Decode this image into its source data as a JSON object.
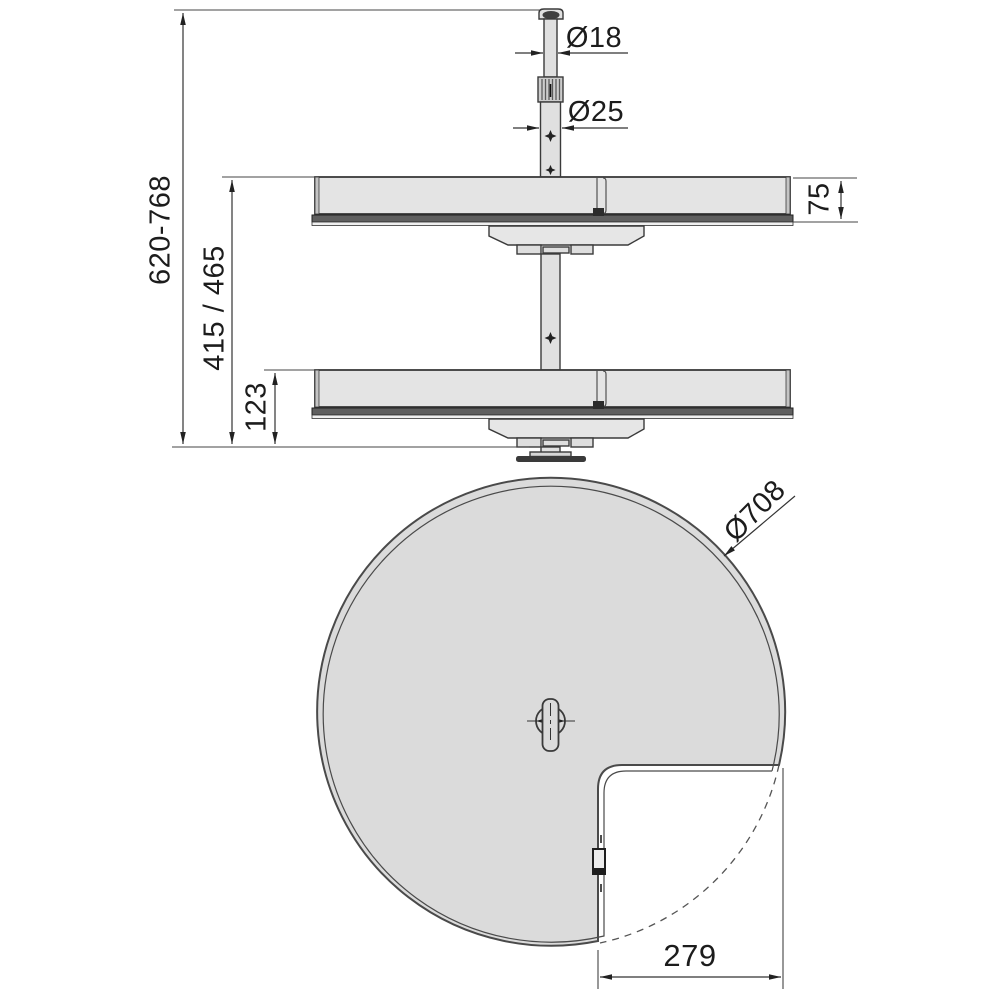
{
  "drawing": {
    "type": "technical-drawing-corner-rotating-tray",
    "views": [
      "side-elevation",
      "top-plan"
    ]
  },
  "colors": {
    "line": "#3a3a3a",
    "fill_light_gray": "#e3e3e3",
    "fill_tray_gray": "#dbdbdb",
    "dark_band": "#5f5f5f",
    "background": "#ffffff"
  },
  "labels": {
    "upper_tube_diameter": "Ø18",
    "lower_tube_diameter": "Ø25",
    "total_height": "620-768",
    "shelf_spacing": "415 / 465",
    "lower_clearance": "123",
    "tray_rim_height": "75",
    "tray_diameter": "Ø708",
    "notch_width": "279"
  }
}
